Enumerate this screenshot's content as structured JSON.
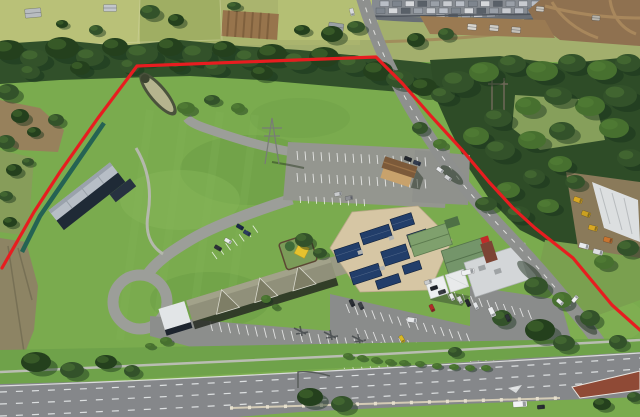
{
  "image": {
    "description": "Aerial drone photograph of a large grassy commercial property (tavern, motel and parking complex) outlined with a red site-boundary line, bordered by bushland, a new housing estate, rural paddocks and a main road",
    "width": 640,
    "height": 417
  },
  "boundary": {
    "color": "#e71d20",
    "stroke_width": 3.2,
    "points": "2,268 34,212 60,172 98,118 137,66 376,57 402,83 431,116 463,151 489,182 513,208 535,228 573,258 612,305 640,330"
  },
  "palette": {
    "grass_base": "#7aab4e",
    "grass_verge": "#6fa24a",
    "farmland_pale": "#a3af6d",
    "road_gray": "#8e908e",
    "highway_gray": "#85878a",
    "dirt_brown": "#8f7150",
    "solar_blue": "#223e6a",
    "tan_roof": "#d6c6a4",
    "green_roof": "#7fa06d",
    "motel_roof": "#90907a",
    "boundary_red": "#e71d20",
    "tree_tones": [
      "#24401d",
      "#33522a",
      "#47702f"
    ],
    "tree_shadow": "#16301a",
    "tree_highlight": "#5d8a3c",
    "stall_color": "#ffffff",
    "house_roof_colors": [
      "#b9bec6",
      "#7e858e",
      "#d6d8db",
      "#596068",
      "#9aa0a8",
      "#c8cbd0"
    ]
  },
  "scene": {
    "trees": [
      [
        8,
        50,
        16,
        10,
        0
      ],
      [
        34,
        58,
        14,
        9,
        1
      ],
      [
        62,
        48,
        17,
        11,
        0
      ],
      [
        90,
        57,
        14,
        9,
        1
      ],
      [
        115,
        47,
        13,
        9,
        0
      ],
      [
        142,
        54,
        16,
        10,
        1
      ],
      [
        170,
        47,
        13,
        9,
        0
      ],
      [
        197,
        54,
        15,
        10,
        1
      ],
      [
        224,
        49,
        12,
        8,
        0
      ],
      [
        248,
        58,
        13,
        9,
        1
      ],
      [
        272,
        54,
        15,
        10,
        0
      ],
      [
        298,
        61,
        14,
        9,
        1
      ],
      [
        324,
        57,
        15,
        10,
        0
      ],
      [
        352,
        64,
        14,
        9,
        1
      ],
      [
        378,
        71,
        15,
        10,
        0
      ],
      [
        400,
        79,
        14,
        9,
        1
      ],
      [
        424,
        87,
        13,
        9,
        0
      ],
      [
        443,
        95,
        12,
        8,
        1
      ],
      [
        262,
        73,
        11,
        7,
        0
      ],
      [
        215,
        68,
        11,
        7,
        1
      ],
      [
        178,
        66,
        9,
        6,
        0
      ],
      [
        130,
        66,
        10,
        7,
        1
      ],
      [
        80,
        68,
        10,
        7,
        0
      ],
      [
        30,
        72,
        10,
        7,
        1
      ],
      [
        458,
        82,
        16,
        11,
        1
      ],
      [
        484,
        72,
        15,
        10,
        2
      ],
      [
        512,
        64,
        14,
        9,
        1
      ],
      [
        542,
        71,
        16,
        10,
        2
      ],
      [
        572,
        63,
        14,
        9,
        1
      ],
      [
        602,
        70,
        15,
        10,
        2
      ],
      [
        628,
        63,
        13,
        9,
        1
      ],
      [
        620,
        96,
        17,
        11,
        1
      ],
      [
        590,
        106,
        15,
        10,
        2
      ],
      [
        558,
        96,
        14,
        9,
        1
      ],
      [
        528,
        106,
        13,
        9,
        2
      ],
      [
        498,
        118,
        14,
        9,
        1
      ],
      [
        476,
        136,
        13,
        9,
        2
      ],
      [
        500,
        150,
        15,
        10,
        1
      ],
      [
        532,
        140,
        14,
        9,
        2
      ],
      [
        562,
        131,
        13,
        9,
        1
      ],
      [
        614,
        128,
        15,
        10,
        2
      ],
      [
        630,
        158,
        13,
        9,
        1
      ],
      [
        560,
        164,
        12,
        8,
        2
      ],
      [
        534,
        177,
        11,
        8,
        1
      ],
      [
        508,
        190,
        12,
        8,
        2
      ],
      [
        486,
        204,
        11,
        7,
        1
      ],
      [
        518,
        214,
        12,
        8,
        1
      ],
      [
        548,
        206,
        11,
        7,
        2
      ],
      [
        575,
        182,
        10,
        7,
        1
      ],
      [
        628,
        248,
        11,
        8,
        1
      ],
      [
        604,
        262,
        10,
        7,
        2
      ],
      [
        536,
        286,
        12,
        9,
        1
      ],
      [
        562,
        300,
        10,
        8,
        2
      ],
      [
        590,
        318,
        10,
        8,
        1
      ],
      [
        618,
        342,
        9,
        7,
        1
      ],
      [
        150,
        12,
        10,
        7,
        1
      ],
      [
        176,
        20,
        8,
        6,
        0
      ],
      [
        332,
        34,
        11,
        8,
        0
      ],
      [
        356,
        27,
        9,
        6,
        1
      ],
      [
        302,
        30,
        8,
        5,
        0
      ],
      [
        96,
        30,
        7,
        5,
        1
      ],
      [
        62,
        24,
        6,
        4,
        0
      ],
      [
        416,
        40,
        9,
        7,
        0
      ],
      [
        446,
        34,
        8,
        6,
        1
      ],
      [
        234,
        6,
        7,
        4,
        1
      ],
      [
        8,
        92,
        11,
        8,
        1
      ],
      [
        20,
        116,
        9,
        7,
        0
      ],
      [
        6,
        142,
        9,
        7,
        1
      ],
      [
        34,
        132,
        7,
        5,
        0
      ],
      [
        56,
        120,
        8,
        6,
        1
      ],
      [
        14,
        170,
        8,
        6,
        0
      ],
      [
        6,
        196,
        7,
        5,
        1
      ],
      [
        28,
        162,
        6,
        4,
        1
      ],
      [
        10,
        222,
        7,
        5,
        0
      ],
      [
        186,
        108,
        9,
        6,
        2
      ],
      [
        212,
        100,
        8,
        5,
        1
      ],
      [
        238,
        108,
        7,
        5,
        2
      ],
      [
        304,
        240,
        9,
        7,
        1
      ],
      [
        320,
        253,
        7,
        5,
        1
      ],
      [
        420,
        128,
        8,
        6,
        1
      ],
      [
        440,
        144,
        7,
        5,
        2
      ],
      [
        502,
        318,
        10,
        8,
        1
      ],
      [
        266,
        299,
        5,
        4,
        2
      ],
      [
        276,
        307,
        4,
        3,
        2
      ],
      [
        36,
        362,
        15,
        10,
        0
      ],
      [
        72,
        370,
        12,
        8,
        1
      ],
      [
        106,
        362,
        11,
        7,
        0
      ],
      [
        132,
        371,
        8,
        6,
        1
      ],
      [
        310,
        397,
        13,
        9,
        0
      ],
      [
        342,
        404,
        11,
        8,
        1
      ],
      [
        540,
        330,
        15,
        11,
        0
      ],
      [
        564,
        343,
        11,
        8,
        1
      ],
      [
        602,
        404,
        9,
        6,
        0
      ],
      [
        634,
        397,
        7,
        5,
        1
      ],
      [
        455,
        352,
        7,
        5,
        1
      ],
      [
        348,
        356,
        5,
        3,
        2
      ],
      [
        362,
        358,
        5,
        3,
        2
      ],
      [
        376,
        360,
        5,
        3,
        2
      ],
      [
        390,
        362,
        5,
        3,
        2
      ],
      [
        404,
        363,
        5,
        3,
        2
      ],
      [
        420,
        364,
        5,
        3,
        2
      ],
      [
        437,
        366,
        5,
        3,
        2
      ],
      [
        454,
        367,
        5,
        3,
        2
      ],
      [
        470,
        368,
        5,
        3,
        2
      ],
      [
        486,
        368,
        5,
        3,
        2
      ],
      [
        166,
        341,
        6,
        4,
        2
      ],
      [
        150,
        346,
        5,
        3,
        2
      ]
    ],
    "cars": [
      [
        338,
        194,
        -10,
        "#c9cbcd"
      ],
      [
        349,
        198,
        -10,
        "#8e9094"
      ],
      [
        408,
        159,
        20,
        "#23272e"
      ],
      [
        417,
        163,
        20,
        "#323c50"
      ],
      [
        440,
        170,
        35,
        "#e6e8ea"
      ],
      [
        448,
        178,
        35,
        "#d0d2d4"
      ],
      [
        240,
        227,
        30,
        "#1c2a4a"
      ],
      [
        247,
        233,
        30,
        "#2b3c5e"
      ],
      [
        228,
        241,
        30,
        "#e9ebec"
      ],
      [
        218,
        248,
        30,
        "#2d3138"
      ],
      [
        412,
        320,
        8,
        "#e6e8ea",
        10,
        5
      ],
      [
        428,
        282,
        -18,
        "#caccce"
      ],
      [
        434,
        288,
        -18,
        "#20242a"
      ],
      [
        442,
        292,
        -18,
        "#383c42"
      ],
      [
        468,
        272,
        -14,
        "#eef0f1",
        13,
        5
      ],
      [
        352,
        303,
        65,
        "#2a2e34"
      ],
      [
        361,
        306,
        65,
        "#3c4046"
      ],
      [
        402,
        339,
        60,
        "#d8b822"
      ],
      [
        432,
        308,
        65,
        "#b02a28"
      ],
      [
        452,
        297,
        65,
        "#e8eaeb"
      ],
      [
        460,
        300,
        65,
        "#dadcde"
      ],
      [
        468,
        303,
        65,
        "#26292e"
      ],
      [
        476,
        306,
        65,
        "#e4e6e8"
      ],
      [
        492,
        312,
        65,
        "#eceeef",
        10,
        5
      ],
      [
        508,
        318,
        65,
        "#2e3238"
      ],
      [
        560,
        302,
        40,
        "#e8eaec"
      ],
      [
        575,
        299,
        -50,
        "#f0f1f2"
      ],
      [
        520,
        404,
        -4,
        "#f2f3f4",
        14,
        6
      ],
      [
        541,
        407,
        -4,
        "#2b2f35"
      ],
      [
        352,
        12,
        75,
        "#d8dadc"
      ],
      [
        578,
        200,
        20,
        "#d8a824",
        9,
        5
      ],
      [
        586,
        214,
        20,
        "#caa020",
        9,
        5
      ],
      [
        593,
        228,
        15,
        "#d8a824",
        9,
        5
      ],
      [
        584,
        246,
        15,
        "#e8eaec",
        10,
        5
      ],
      [
        598,
        252,
        15,
        "#dcdee0",
        10,
        5
      ],
      [
        608,
        240,
        15,
        "#c87430",
        9,
        5
      ]
    ],
    "sheds": [
      [
        33,
        13,
        -5,
        16,
        9,
        "#b8bcc0"
      ],
      [
        110,
        8,
        0,
        13,
        7,
        "#c2c6ca"
      ],
      [
        336,
        27,
        8,
        15,
        8,
        "#9aa0a4"
      ],
      [
        472,
        27,
        5,
        9,
        6,
        "#d8d5ce"
      ],
      [
        494,
        28,
        5,
        9,
        6,
        "#cfccc4"
      ],
      [
        516,
        30,
        5,
        9,
        6,
        "#c4c0b8"
      ],
      [
        540,
        9,
        5,
        8,
        5,
        "#ccc8c0"
      ],
      [
        596,
        18,
        4,
        8,
        5,
        "#b8b4aa"
      ]
    ],
    "stall_rows": [
      {
        "x": 297,
        "y": 151,
        "dx": 8,
        "dy": 0.4,
        "lx": 0.8,
        "ly": 9,
        "n": 17
      },
      {
        "x": 297,
        "y": 173,
        "dx": 8,
        "dy": 0.4,
        "lx": 0.8,
        "ly": 9,
        "n": 17
      },
      {
        "x": 300,
        "y": 196,
        "dx": 8,
        "dy": 0.4,
        "lx": 0.6,
        "ly": 7,
        "n": 9
      },
      {
        "x": 210,
        "y": 321,
        "dx": 9,
        "dy": 1.1,
        "lx": 2.5,
        "ly": 10,
        "n": 23
      },
      {
        "x": 243,
        "y": 349,
        "dx": 9,
        "dy": 0.9,
        "lx": 2.5,
        "ly": 10,
        "n": 17
      },
      {
        "x": 346,
        "y": 304,
        "dx": 8.6,
        "dy": 2.1,
        "lx": 3.5,
        "ly": 9,
        "n": 15
      },
      {
        "x": 356,
        "y": 328,
        "dx": 8.6,
        "dy": 2.0,
        "lx": 3.5,
        "ly": 9,
        "n": 17
      },
      {
        "x": 446,
        "y": 290,
        "dx": 8.2,
        "dy": 2.0,
        "lx": 3.5,
        "ly": 9,
        "n": 11
      },
      {
        "x": 212,
        "y": 252,
        "dx": 6.8,
        "dy": -4.4,
        "lx": 5,
        "ly": 7,
        "n": 7
      }
    ],
    "house_rows": [
      {
        "x": 380,
        "y": 1,
        "dx": 12.6,
        "n": 13,
        "w": 9,
        "h": 5.5
      },
      {
        "x": 376,
        "y": 8,
        "dx": 12.6,
        "n": 13,
        "w": 9,
        "h": 5.5
      },
      {
        "x": 436,
        "y": 14,
        "dx": 12.6,
        "n": 8,
        "w": 9,
        "h": 5.5
      },
      {
        "x": 586,
        "y": 1,
        "dx": 12,
        "n": 5,
        "w": 9,
        "h": 5
      }
    ]
  }
}
